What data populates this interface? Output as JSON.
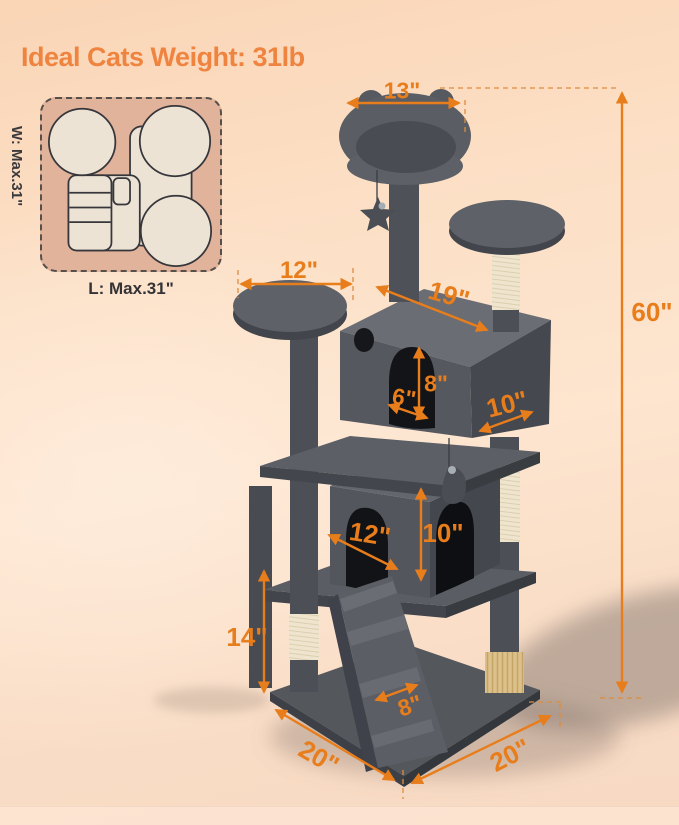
{
  "title": "Ideal Cats Weight: 31lb",
  "colors": {
    "accent_orange": "#e87d1c",
    "title_orange": "#ef8440",
    "background_peach": "#fcdfc5",
    "tree_gray": "#55585e",
    "sisal_cream": "#efe5cf",
    "inset_tan": "#e2b39b"
  },
  "footprint": {
    "width_label": "W: Max.31\"",
    "length_label": "L: Max.31\""
  },
  "dimensions": {
    "top_perch_width": "13\"",
    "total_height": "60\"",
    "upper_platform_width": "12\"",
    "upper_condo_length": "19\"",
    "door_width": "6\"",
    "door_height": "8\"",
    "upper_condo_depth": "10\"",
    "lower_condo_width": "12\"",
    "lower_condo_height": "10\"",
    "lower_section_height": "14\"",
    "ramp_width": "8\"",
    "base_width": "20\"",
    "base_depth": "20\""
  }
}
